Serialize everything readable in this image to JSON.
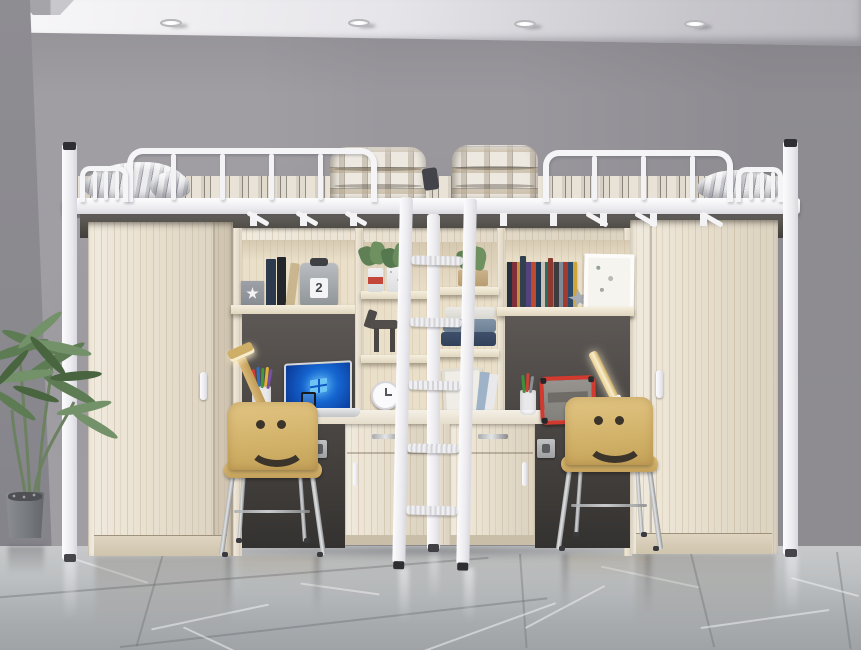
{
  "image": {
    "kind": "product-photo",
    "subject": "White metal loft-bed combination with two study desks, bookshelves, two wardrobes, a center ladder and two smiley-face chairs in a gray room with marble tile floor"
  },
  "visible_text": {
    "canister_label": "2"
  },
  "palette": {
    "wall": "#9A989D",
    "left_wall": "#8C8B90",
    "ceiling": "#F2F1F4",
    "floor": "#B9BCBE",
    "bed_frame_white": "#F4F4F7",
    "wood_light": "#EBE3D3",
    "back_panel_dark": "#544F4C",
    "desk_top": "#F2EDE2",
    "chair_wood": "#D8B970",
    "laptop_screen_blue": "#1D64CE",
    "tablet_frame_red": "#D23A30",
    "blanket_plaid": "#ECE8E0",
    "mattress_stripe": "#E1DACE",
    "plant_green": "#5F7D55",
    "plant_pot": "#7B7E82",
    "chrome": "#C4C6C8"
  },
  "objects": {
    "spotlight_count": 4,
    "ladder_rung_count": 5,
    "chair_count": 2
  }
}
